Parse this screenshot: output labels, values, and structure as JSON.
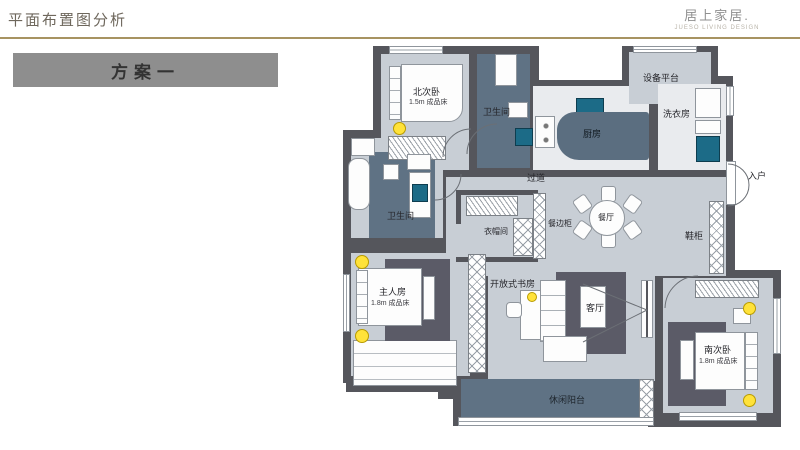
{
  "header": {
    "title": "平面布置图分析",
    "logo": {
      "name": "居上家居.",
      "subtitle": "JUESO LIVING DESIGN"
    }
  },
  "scheme": {
    "label": "方案一"
  },
  "plan": {
    "rooms": {
      "north_bedroom": {
        "label": "北次卧",
        "sub": "1.5m 成品床"
      },
      "bath_top": {
        "label": "卫生间"
      },
      "kitchen": {
        "label": "厨房"
      },
      "equipment_platform": {
        "label": "设备平台"
      },
      "laundry": {
        "label": "洗衣房"
      },
      "entry": {
        "label": "入户"
      },
      "shoe_cabinet": {
        "label": "鞋柜"
      },
      "corridor": {
        "label": "过道"
      },
      "dining": {
        "label": "餐厅"
      },
      "sideboard": {
        "label": "餐边柜"
      },
      "cloakroom": {
        "label": "衣帽间"
      },
      "bath_left": {
        "label": "卫生间"
      },
      "master_bedroom": {
        "label": "主人房",
        "sub": "1.8m 成品床"
      },
      "study": {
        "label": "开放式书房"
      },
      "living": {
        "label": "客厅"
      },
      "south_bedroom": {
        "label": "南次卧",
        "sub": "1.8m 成品床"
      },
      "balcony": {
        "label": "休闲阳台"
      }
    },
    "colors": {
      "wall": "#55565c",
      "floor_light": "#c8ced5",
      "floor_white": "#e9ebee",
      "floor_dark": "#5f7284",
      "rug": "#5b5b67",
      "fixture_teal": "#1c6b87",
      "lamp_yellow": "#ffe23a",
      "accent_gold": "#a79361"
    }
  }
}
